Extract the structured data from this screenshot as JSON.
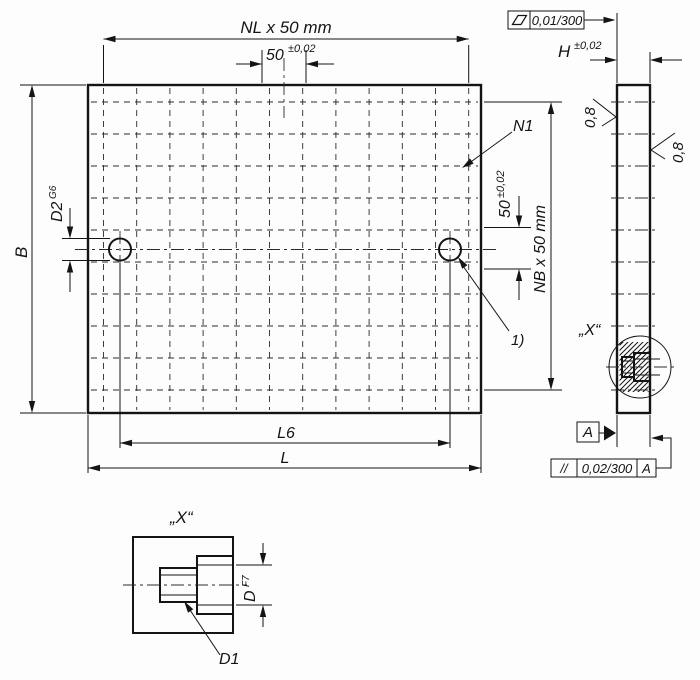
{
  "front": {
    "dim_nl": "NL x 50 mm",
    "dim_50_top": {
      "value": "50",
      "tol": "±0,02"
    },
    "dim_b": "B",
    "dim_d2": {
      "value": "D2",
      "fit": "G6"
    },
    "surface_mark": "N1",
    "dim_50_side": {
      "value": "50",
      "tol": "±0,02"
    },
    "dim_nb": "NB x 50 mm",
    "footnote": "1)",
    "dim_l6": "L6",
    "dim_l": "L"
  },
  "side": {
    "flatness_tol": "0,01/300",
    "dim_h": {
      "value": "H",
      "tol": "±0,02"
    },
    "roughness_left": "0,8",
    "roughness_right": "0,8",
    "detail_label": "„X“",
    "datum": "A",
    "parallelism": {
      "symbol": "//",
      "tol": "0,02/300",
      "datum": "A"
    }
  },
  "detail": {
    "title": "„X“",
    "dim_d": {
      "value": "D",
      "fit": "F7"
    },
    "leader_d1": "D1"
  },
  "colors": {
    "plate_fill": "#dcdcdc",
    "line": "#141414",
    "background": "#fdfdfd"
  }
}
